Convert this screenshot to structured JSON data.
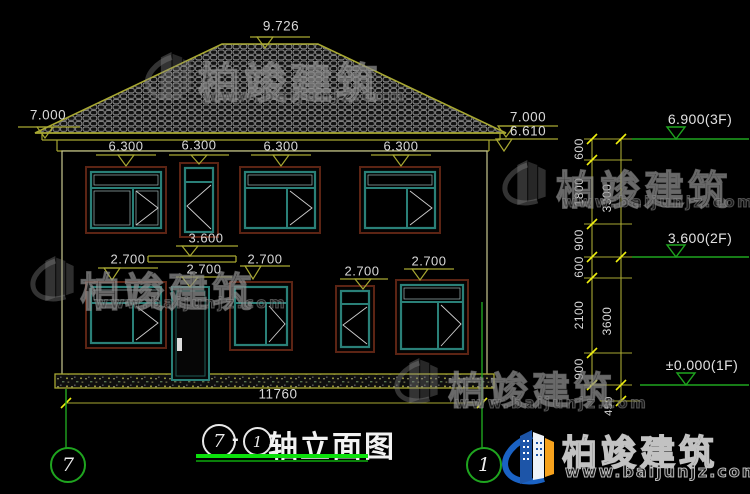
{
  "drawing": {
    "title": {
      "axis_from": "7",
      "separator": "-",
      "axis_to": "1",
      "label": "轴立面图"
    },
    "axis_bubbles": {
      "left": "7",
      "right": "1"
    },
    "dims": {
      "ridge": "9.726",
      "eave_left": "7.000",
      "eave_right": "7.000",
      "fascia_right": "6.610",
      "w2f": [
        "6.300",
        "6.300",
        "6.300",
        "6.300"
      ],
      "canopy": "3.600",
      "w1f": [
        "2.700",
        "2.700",
        "2.700",
        "2.700",
        "2.700"
      ],
      "total_width": "11760",
      "chain_small": [
        "600",
        "1800",
        "900",
        "600",
        "2100",
        "900"
      ],
      "chain_large": [
        "3300",
        "3600"
      ],
      "plinth_height": "450"
    },
    "levels": {
      "f3": "6.900(3F)",
      "f2": "3.600(2F)",
      "f1": "±0.000(1F)"
    }
  },
  "brand": {
    "name": "柏竣建筑",
    "site": "www.baijunjz.com"
  },
  "colors": {
    "background": "#000000",
    "line_yellow": "#a8a832",
    "tick_yellow": "#f0f010",
    "axis_green": "#1fa51f",
    "title_underline_green": "#0ce00c",
    "window_teal": "#2a8078",
    "frame_maroon": "#5c2414",
    "text_white": "#d9d9d9",
    "logo_blue": "#1a62c4",
    "logo_orange": "#f6a21d"
  }
}
